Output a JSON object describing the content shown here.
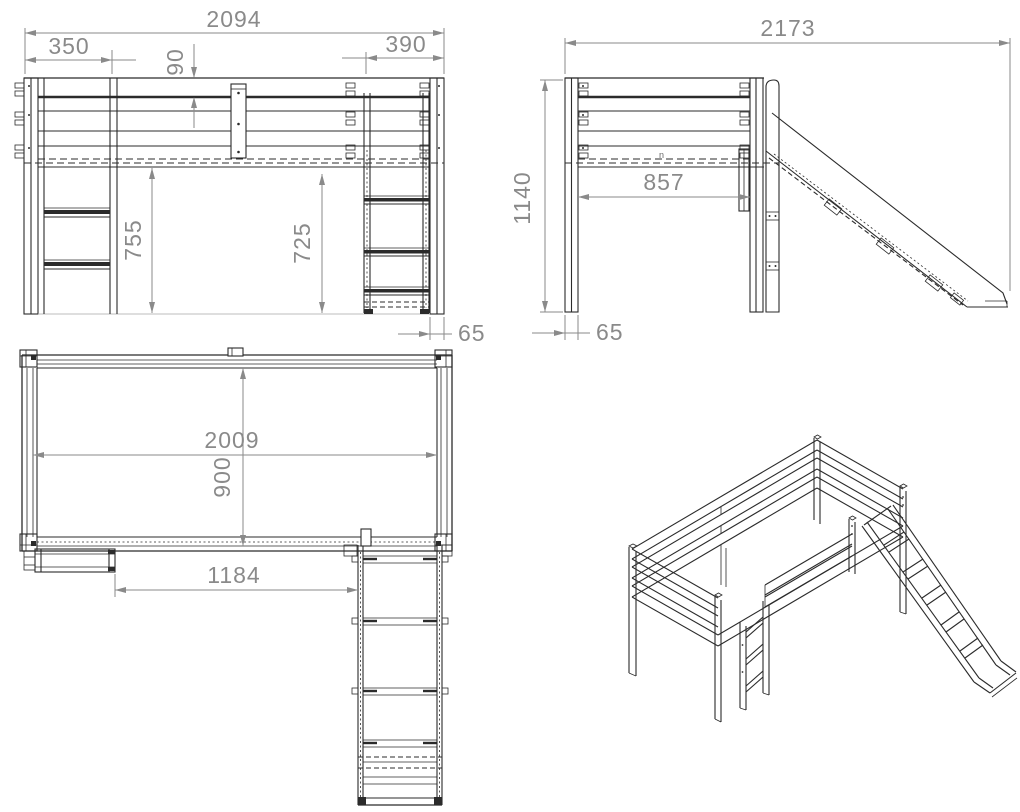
{
  "drawing": {
    "background": "#ffffff",
    "line_color": "#2b2b2b",
    "dimension_color": "#8a8a8a"
  },
  "views": {
    "front": {
      "dims": {
        "overall_width": "2094",
        "ladder_width": "350",
        "top_rail_plank": "90",
        "slide_ladder_width": "390",
        "clearance_left": "755",
        "clearance_right": "725",
        "post_width": "65"
      }
    },
    "side": {
      "dims": {
        "overall_depth": "2173",
        "overall_height": "1140",
        "post_spacing": "857",
        "post_depth": "65"
      },
      "surface_mark": "n"
    },
    "plan": {
      "dims": {
        "bed_length": "2009",
        "bed_width": "900",
        "ladder_to_slide": "1184"
      }
    }
  }
}
